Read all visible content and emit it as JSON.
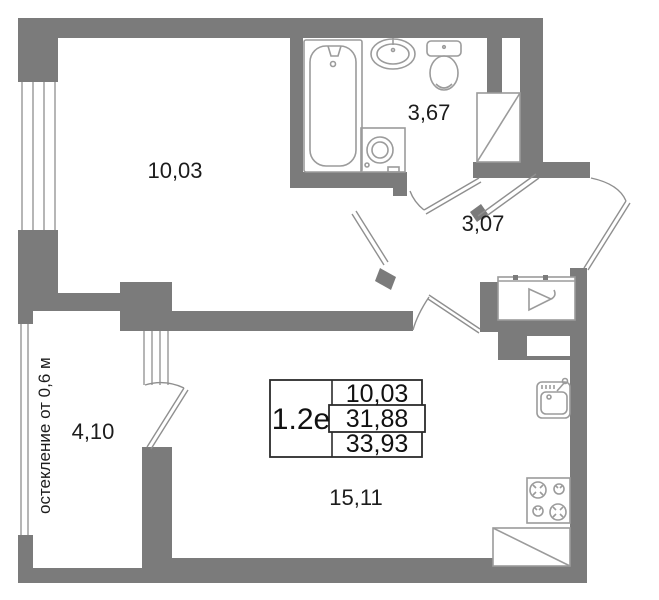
{
  "plan": {
    "unit_id": "1.2е",
    "glazing_note": "остекление от 0,6 м",
    "rooms": {
      "living_room": {
        "area": "10,03"
      },
      "bathroom": {
        "area": "3,67"
      },
      "hallway": {
        "area": "3,07"
      },
      "balcony": {
        "area": "4,10"
      },
      "kitchen_living": {
        "area": "15,11"
      }
    },
    "area_table": {
      "unit_id": "1.2е",
      "rows": [
        "10,03",
        "31,88",
        "33,93"
      ]
    },
    "colors": {
      "wall": "#7b7b7b",
      "fixtures": "#9b9b9b",
      "text": "#1c1c1c"
    }
  }
}
